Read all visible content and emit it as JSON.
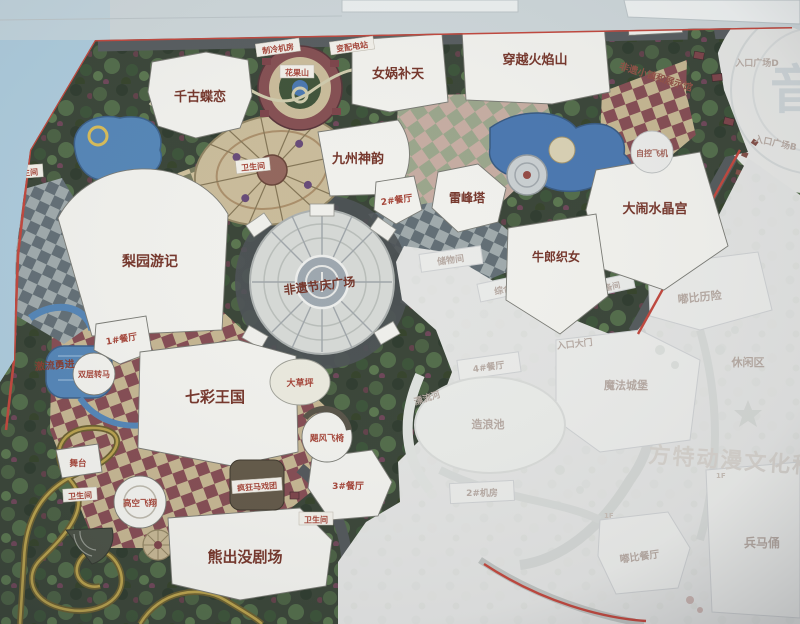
{
  "labels": {
    "qiangudielian": "千古蝶恋",
    "nvwabutian": "女娲补天",
    "chuanyuehuoyanshan": "穿越火焰山",
    "jiuzhoushenyun": "九州神韵",
    "leifengta": "雷峰塔",
    "daonaoshuijinggong": "大闹水晶宫",
    "niulangzhinv": "牛郎织女",
    "liyuanyouji": "梨园游记",
    "qicaiwangguo": "七彩王国",
    "xiongchumojuchang": "熊出没剧场",
    "feiyijieqing": "非遗节庆广场",
    "feiyixiaozhen": "非遗小镇和展示馆",
    "jiliuyongjin": "激流勇进",
    "gaokongfeixiang": "高空飞翔",
    "shuangcengzhuanma": "双层转马",
    "jufengfeiyi": "飓风飞椅",
    "fengkuangmaxituan": "疯狂马戏团",
    "zikongfeiji": "自控飞机",
    "huaguoshan": "花果山",
    "wutai": "舞台",
    "dacaoping": "大草坪",
    "zongcang": "总仓",
    "zhilengjifang": "制冷机房",
    "bianpeidianzhan": "变配电站",
    "canting1": "1#餐厅",
    "canting2": "2#餐厅",
    "canting3": "3#餐厅",
    "weishengjian": "卫生间"
  },
  "faded": {
    "rukouguangchangD": "入口广场D",
    "rukouguangchangE": "入口广场E",
    "rukouguangchangB": "入口广场B",
    "chuwujian": "储物间",
    "zonghefuwulou": "综合服务楼",
    "shebeijian": "设备间",
    "rukoudamen": "入口大门",
    "dubilixian": "嘟比历险",
    "mofachengbao": "魔法城堡",
    "xiuxianqu": "休闲区",
    "dubicanting": "嘟比餐厅",
    "bingmayong": "兵马俑",
    "canting4": "4#餐厅",
    "zaolangchi": "造浪池",
    "piaoliuhe": "漂流河",
    "jifang2": "2#机房",
    "floor1": "1F",
    "watermark": "音",
    "brand": "方特动漫文化科技"
  },
  "colors": {
    "map_border_red": "#bf372c",
    "water_blue": "#477cb3",
    "vivid_label_red": "#6b2418",
    "faded_text": "#b3a49c",
    "vegetation_green": "#2a3526"
  }
}
